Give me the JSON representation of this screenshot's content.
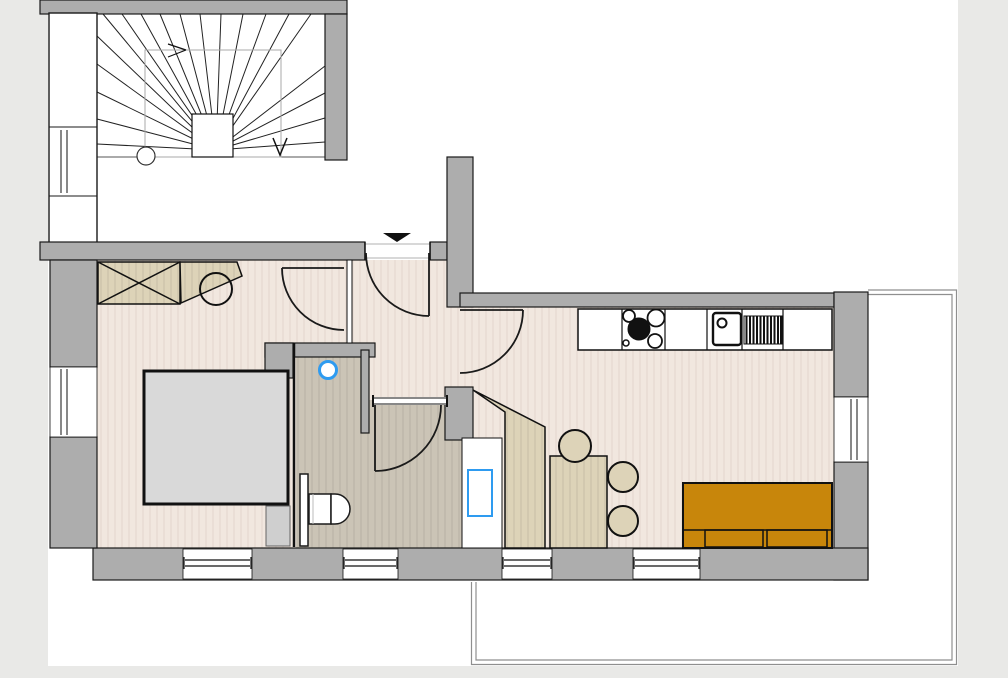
{
  "title": "apartment-floor-plan",
  "colors": {
    "background": "#e9e9e7",
    "paper": "#ffffff",
    "wall": "#adadad",
    "outline": "#1a1a1a",
    "floor_main": "#f1e7df",
    "floor_bath": "#cbc4b6",
    "furniture_beige": "#ddd3b8",
    "bed_gray": "#d9d9d9",
    "sofa_orange": "#c8860b",
    "accent_blue": "#2e9bf0",
    "terrace_line": "#8f8f8f"
  },
  "rooms": [
    {
      "name": "stairwell",
      "elements": [
        "winder-stair-treads",
        "landing",
        "newel-circle",
        "direction-arrows",
        "window"
      ]
    },
    {
      "name": "hall",
      "elements": [
        "entrance-door",
        "entrance-arrow-marker",
        "bedroom-door",
        "bathroom-door",
        "living-room-door"
      ]
    },
    {
      "name": "bedroom",
      "elements": [
        "wardrobe-crossed",
        "desk",
        "chair",
        "double-bed",
        "nightstand",
        "window"
      ]
    },
    {
      "name": "bathroom",
      "elements": [
        "toilet",
        "shower-tray",
        "drain-circle",
        "radiator-strip",
        "threshold"
      ]
    },
    {
      "name": "kitchen-living-room",
      "elements": [
        "counter-cabinets",
        "stove-4-burners",
        "sink-with-faucet",
        "drainer-grill",
        "dining-table",
        "chairs-3",
        "sofa",
        "windows"
      ]
    },
    {
      "name": "terrace",
      "elements": [
        "double-line-boundary"
      ]
    }
  ]
}
